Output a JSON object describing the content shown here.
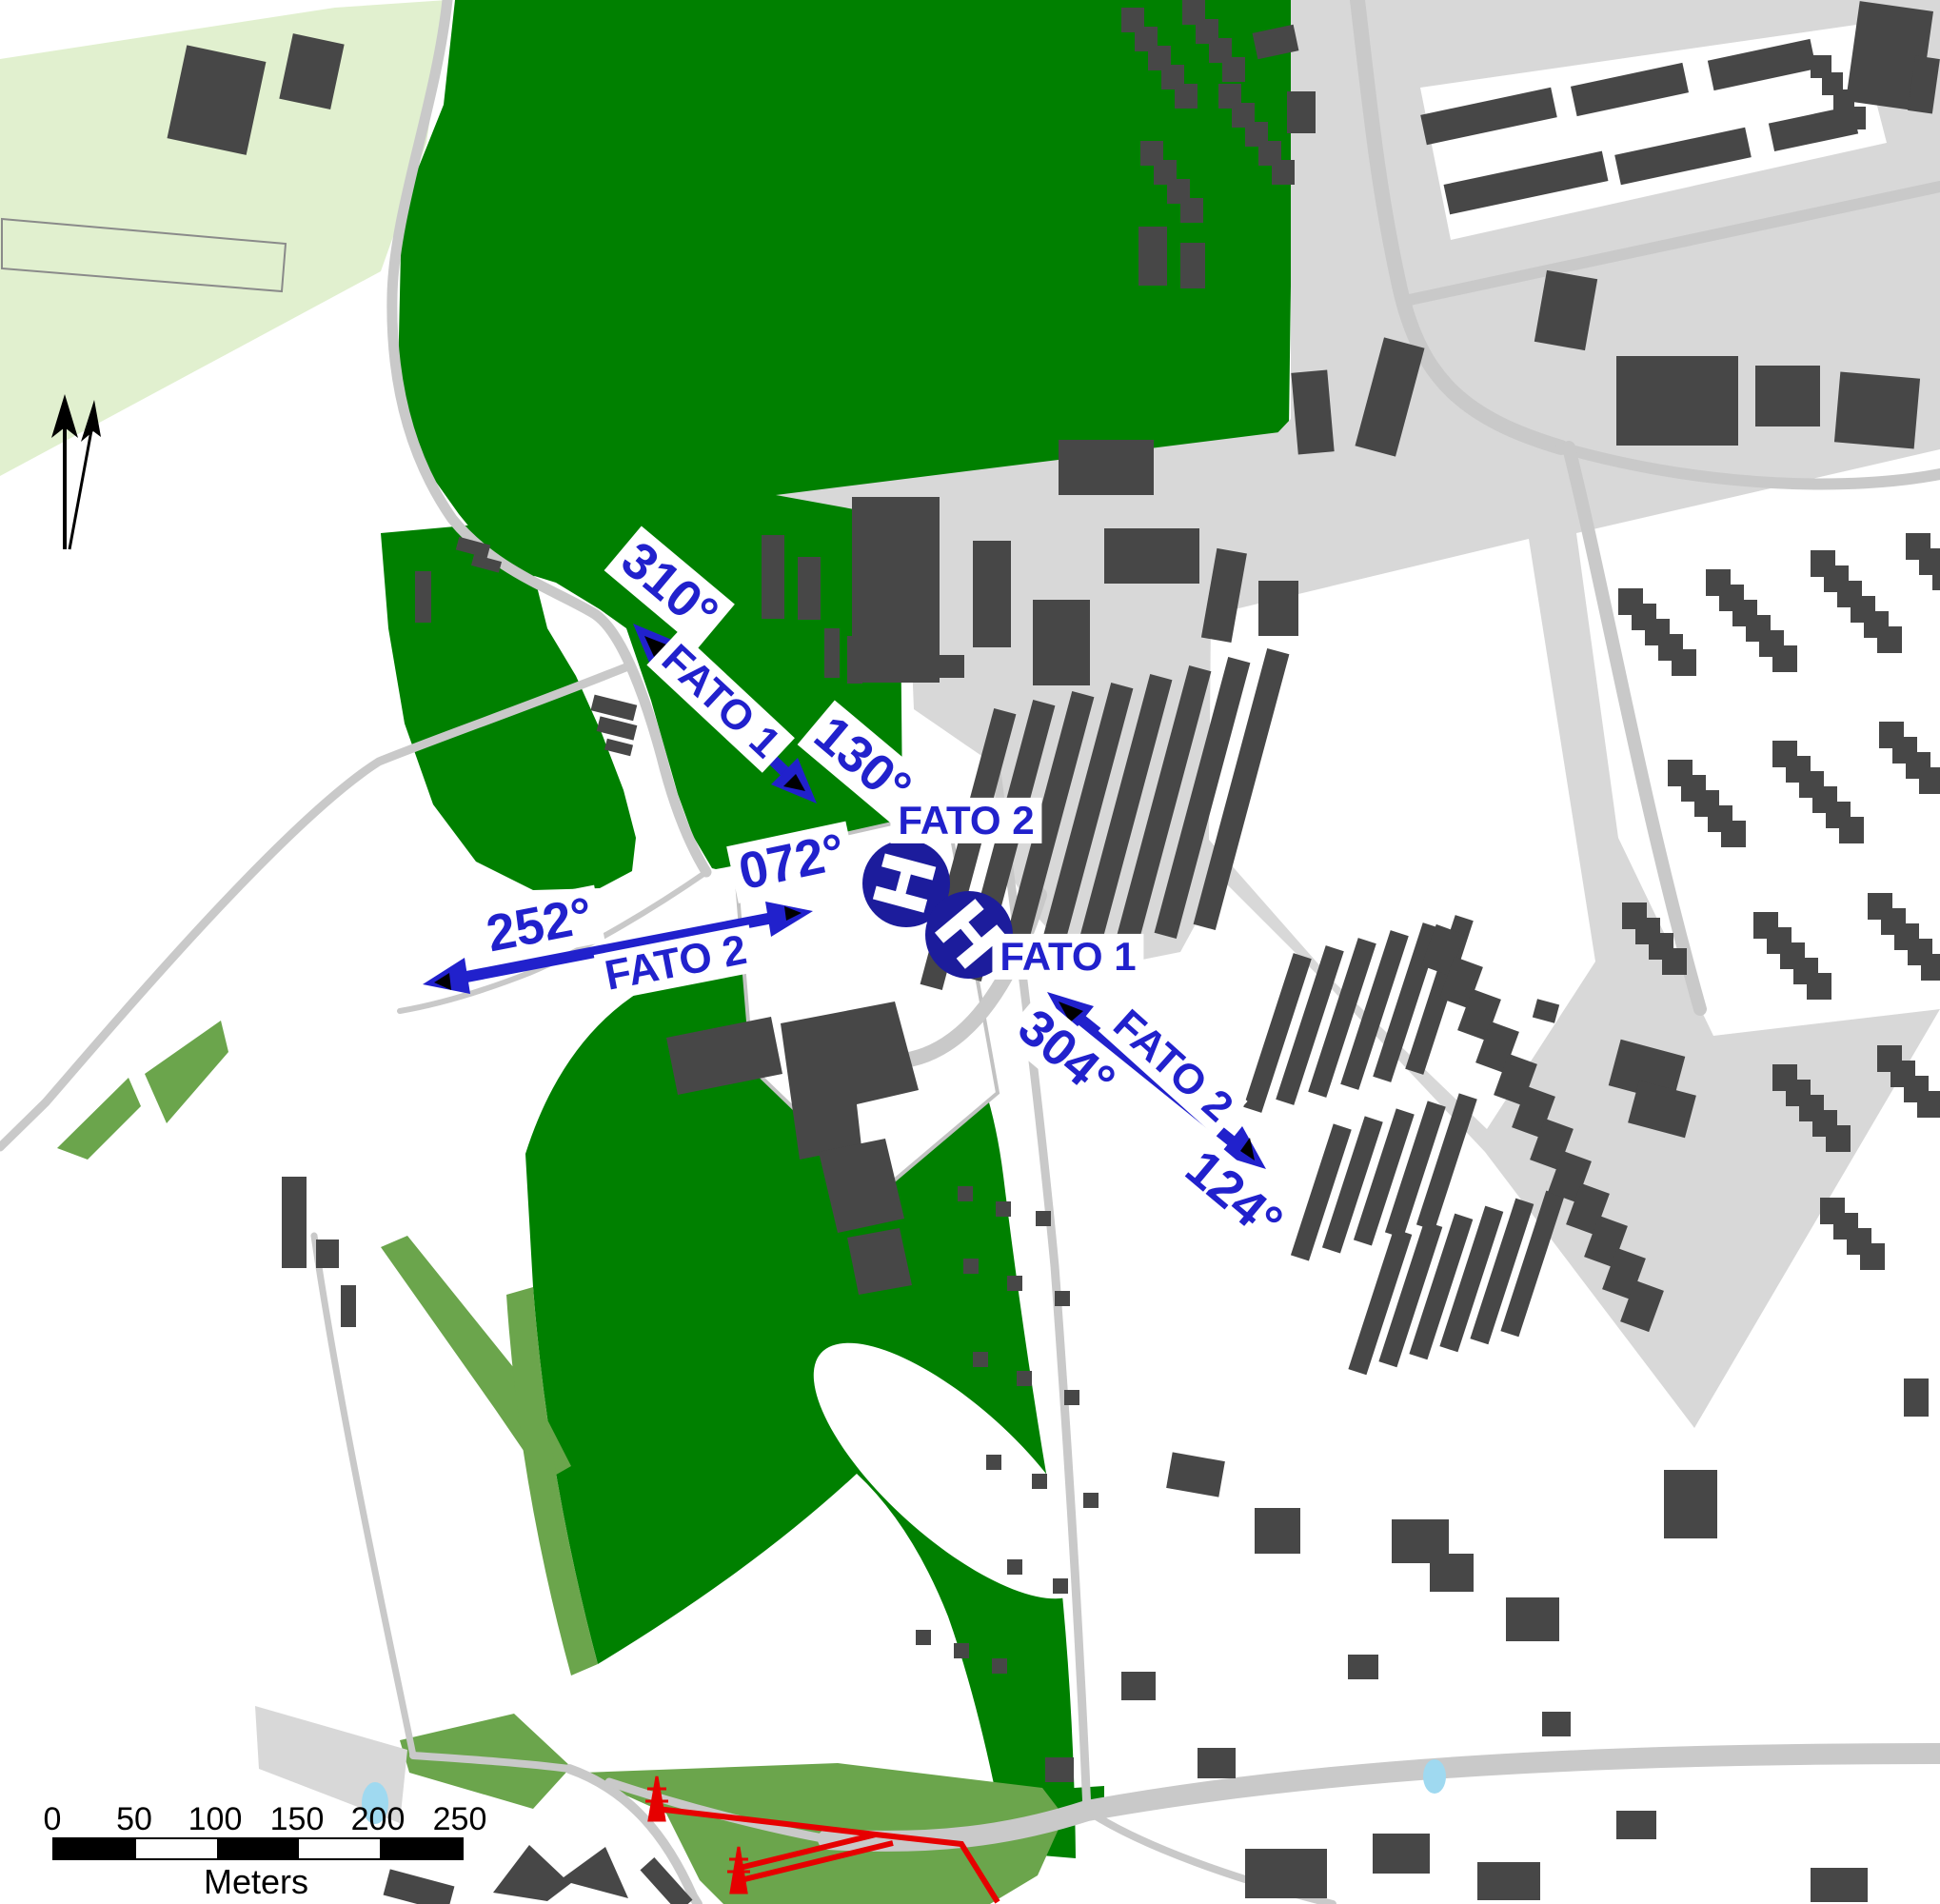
{
  "map": {
    "type": "heliport-approach-chart",
    "arrows": [
      {
        "label": "FATO 1",
        "from_bearing": "310°",
        "to_bearing": "130°"
      },
      {
        "label": "FATO 2",
        "from_bearing": "252°",
        "to_bearing": "072°"
      },
      {
        "label": "FATO 2",
        "from_bearing": "304°",
        "to_bearing": "124°"
      }
    ],
    "helipads": [
      {
        "symbol": "H",
        "label": "FATO 2"
      },
      {
        "symbol": "H",
        "label": "FATO 1"
      }
    ],
    "scale_bar": {
      "ticks": [
        "0",
        "50",
        "100",
        "150",
        "200",
        "250"
      ],
      "unit": "Meters"
    },
    "colors": {
      "forest_green": "#008000",
      "field_green": "#e1f0cf",
      "vegetation_green": "#6ba54c",
      "road_gray": "#c9c9c9",
      "urban_gray": "#d8d8d8",
      "building_gray": "#474747",
      "label_blue": "#2121cc",
      "helipad_blue": "#1c1c9c",
      "powerline_red": "#e60000",
      "water_blue": "#9fd9f0"
    }
  }
}
